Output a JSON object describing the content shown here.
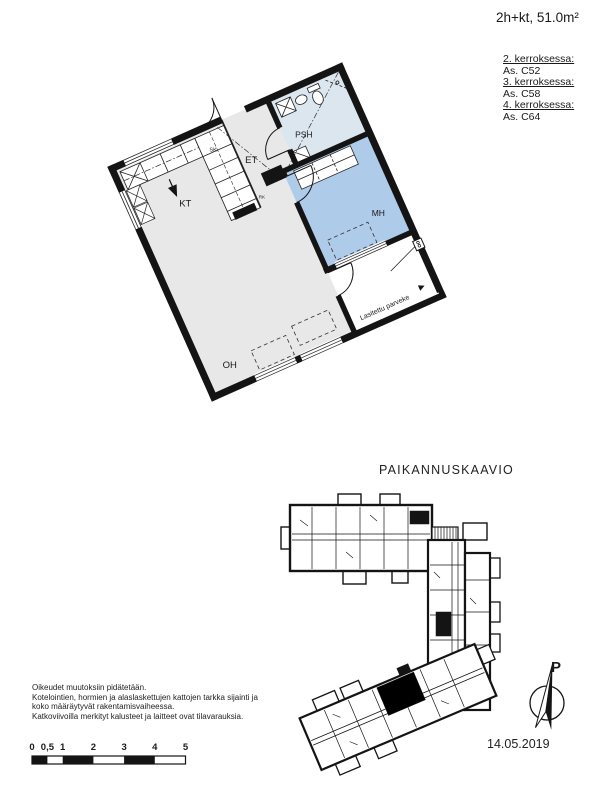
{
  "header": {
    "area_label": "2h+kt, 51.0m²"
  },
  "floors": [
    {
      "label": "2. kerroksessa:",
      "unit": "As. C52"
    },
    {
      "label": "3. kerroksessa:",
      "unit": "As. C58"
    },
    {
      "label": "4. kerroksessa:",
      "unit": "As. C64"
    }
  ],
  "plan": {
    "rooms": {
      "kt": "KT",
      "et": "ET",
      "sk": "SK",
      "psh": "PSH",
      "mh": "MH",
      "oh": "OH",
      "rk": "RK",
      "balcony": "Lasitettu parveke"
    }
  },
  "location": {
    "title": "PAIKANNUSKAAVIO"
  },
  "compass": {
    "north_label": "P"
  },
  "notes": {
    "lines": [
      "Oikeudet muutoksiin pidätetään.",
      "Kotelointien, hormien ja alaslaskettujen kattojen tarkka sijainti ja",
      "koko määräytyvät rakentamisvaiheessa.",
      "Katkoviivoilla merkityt kalusteet ja laitteet ovat tilavarauksia."
    ]
  },
  "scalebar": {
    "ticks": [
      "0",
      "0,5",
      "1",
      "2",
      "3",
      "4",
      "5"
    ]
  },
  "footer": {
    "date": "14.05.2019"
  },
  "colors": {
    "wall": "#141414",
    "room_gray": "#e8e8e8",
    "psh_blue": "#dbe6ef",
    "mh_blue": "#aecbe9",
    "highlight_black": "#000000"
  }
}
